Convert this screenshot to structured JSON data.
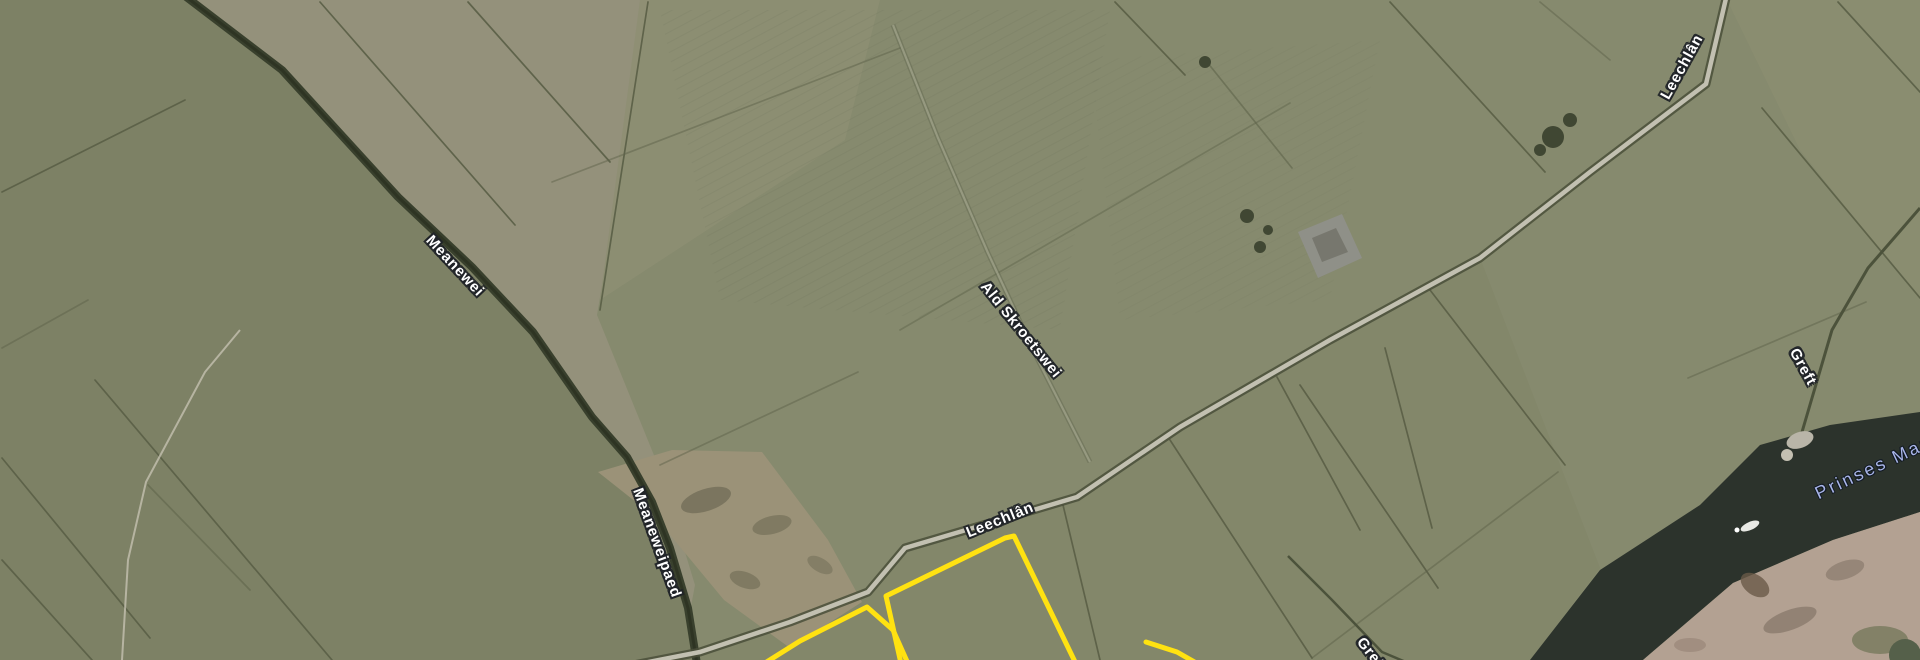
{
  "map": {
    "view": "satellite-imagery",
    "region_hint": "farmland polder with canal",
    "labels": [
      {
        "text": "Meanewei",
        "kind": "road",
        "x": 455,
        "y": 266,
        "rot": 47,
        "size": 15
      },
      {
        "text": "Meaneweipaed",
        "kind": "road",
        "x": 657,
        "y": 543,
        "rot": 70,
        "size": 15
      },
      {
        "text": "Ald Skroetswei",
        "kind": "road",
        "x": 1021,
        "y": 330,
        "rot": 51,
        "size": 15
      },
      {
        "text": "Leechlân",
        "kind": "road",
        "x": 1000,
        "y": 520,
        "rot": -22,
        "size": 15
      },
      {
        "text": "Leechlân",
        "kind": "road",
        "x": 1682,
        "y": 67,
        "rot": -61,
        "size": 15
      },
      {
        "text": "Greft",
        "kind": "road",
        "x": 1803,
        "y": 367,
        "rot": 61,
        "size": 15
      },
      {
        "text": "Greft",
        "kind": "road",
        "x": 1372,
        "y": 655,
        "rot": 52,
        "size": 15
      },
      {
        "text": "Prinses Mar",
        "kind": "water",
        "x": 1872,
        "y": 468,
        "rot": -25,
        "size": 18
      }
    ],
    "highlighted_parcels": {
      "count": 3,
      "outline_color": "#ffe211"
    },
    "palette": {
      "field_base": "#868a6e",
      "field_dark_green": "#7d8165",
      "field_tan": "#94917b",
      "bare_soil": "#9b9278",
      "ditch": "#5a5f46",
      "canal_dark": "#39402d",
      "road_light": "#c2c0b1",
      "water": "#2c332c",
      "shore": "#b3a192",
      "highlight": "#ffe211",
      "road_label_text": "#ffffff",
      "water_label_text": "#a9b5e8"
    }
  }
}
